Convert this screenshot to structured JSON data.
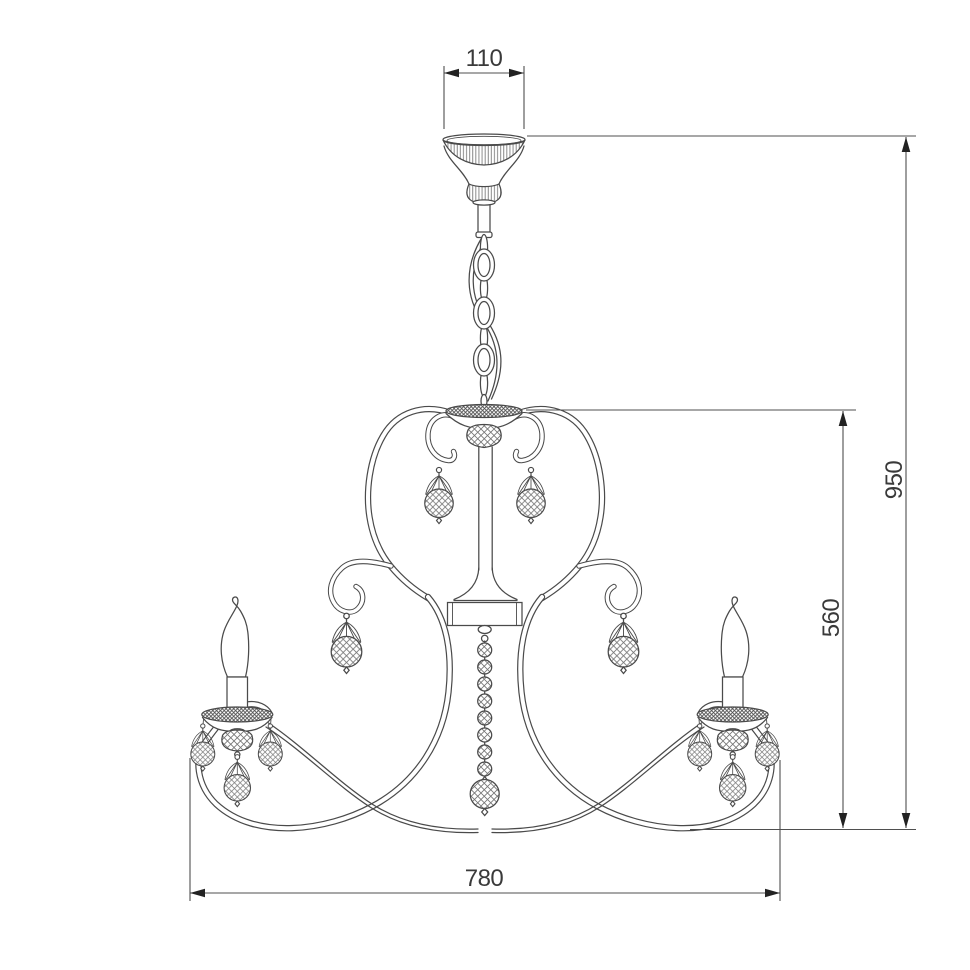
{
  "canvas": {
    "width": 970,
    "height": 970,
    "background": "#ffffff"
  },
  "palette": {
    "line": "#4a4a4a",
    "hatch": "#777777",
    "hatch_dark": "#4e4e4e",
    "dim": "#4f4f4f",
    "arrow": "#222222",
    "text": "#3a3a3a"
  },
  "drawing": {
    "kind": "chandelier-dimension-diagram",
    "style": "single-line technical drawing, white background"
  },
  "dimensions": {
    "canopy_width": {
      "value": "110",
      "orientation": "horizontal",
      "location": "top"
    },
    "overall_height": {
      "value": "950",
      "orientation": "vertical",
      "location": "right-outer"
    },
    "body_height": {
      "value": "560",
      "orientation": "vertical",
      "location": "right-inner"
    },
    "body_width": {
      "value": "780",
      "orientation": "horizontal",
      "location": "bottom"
    }
  }
}
